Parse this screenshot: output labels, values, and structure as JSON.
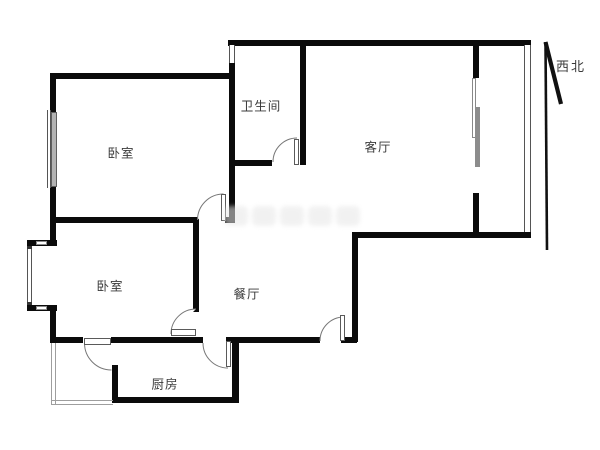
{
  "rooms": {
    "bedroom1": {
      "label": "卧室"
    },
    "bathroom": {
      "label": "卫生间"
    },
    "living": {
      "label": "客厅"
    },
    "bedroom2": {
      "label": "卧室"
    },
    "dining": {
      "label": "餐厅"
    },
    "kitchen": {
      "label": "厨房"
    }
  },
  "compass": {
    "label": "西北",
    "direction": "northwest"
  },
  "colors": {
    "wall": "#0b0b0b",
    "window_frame": "#555555",
    "window_fill": "#b3b3b3",
    "door_edge": "#5a5a5a",
    "arc": "#777777",
    "label": "#3a3a3a",
    "sliding_panel": "#8c8c8c",
    "arrow": "#111111",
    "thin_line": "#9e9e9e",
    "watermark": "#e7e7e7"
  }
}
